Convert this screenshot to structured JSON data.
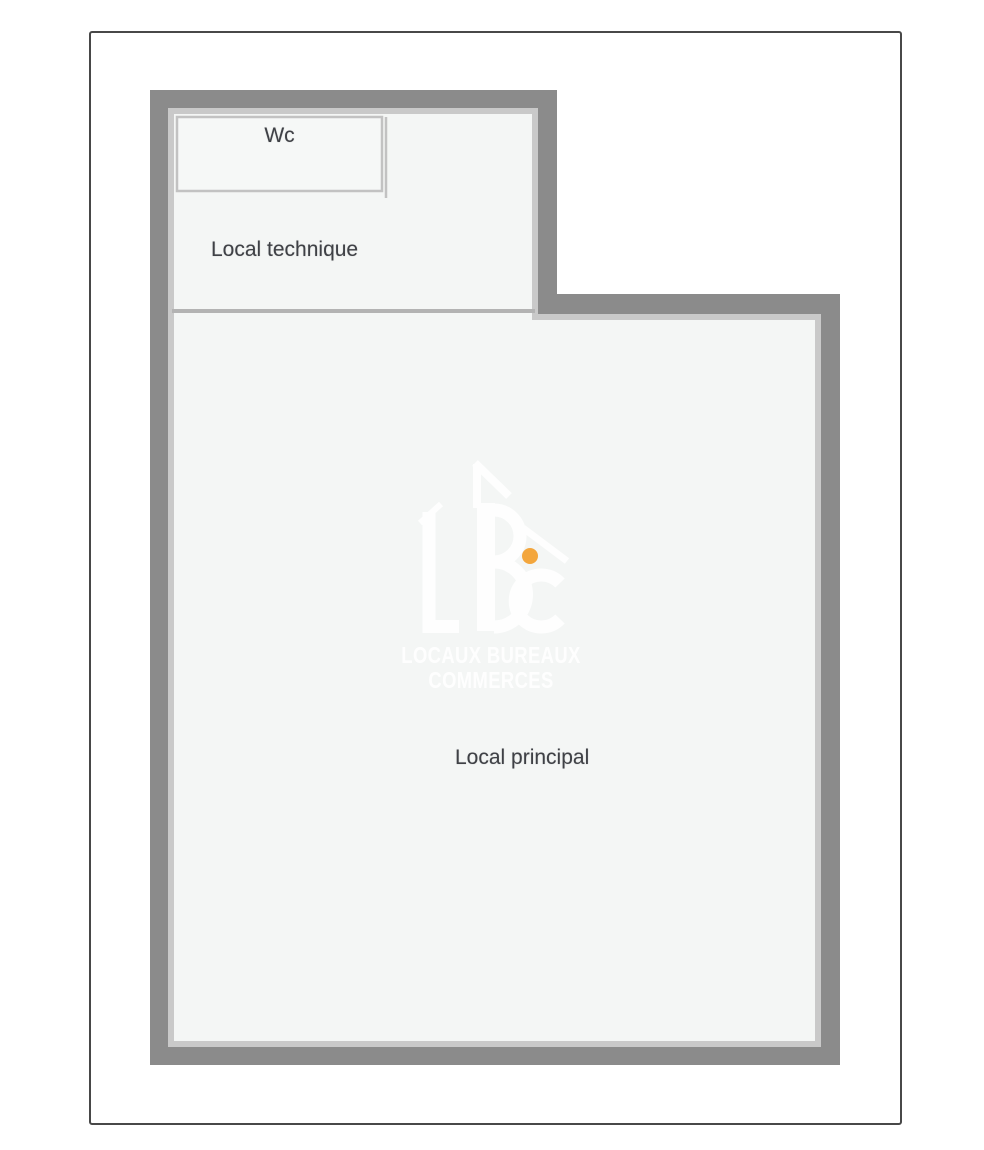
{
  "page": {
    "background_color": "#ffffff",
    "frame_border_color": "#484848"
  },
  "floorplan": {
    "wall_color": "#8b8b8b",
    "wall_lining_color": "#c9c9c9",
    "partition_color": "#b3b3b3",
    "floor_color": "#f4f6f5",
    "room_border_color": "#c2c2c2",
    "label_color": "#3f4146",
    "rooms": [
      {
        "id": "wc",
        "label": "Wc"
      },
      {
        "id": "local-technique",
        "label": "Local technique"
      },
      {
        "id": "local-principal",
        "label": "Local principal"
      }
    ]
  },
  "watermark": {
    "brand_initials": "LBC",
    "line1": "LOCAUX BUREAUX",
    "line2": "COMMERCES",
    "text_color": "#ffffff",
    "accent_color": "#f3a63d"
  }
}
